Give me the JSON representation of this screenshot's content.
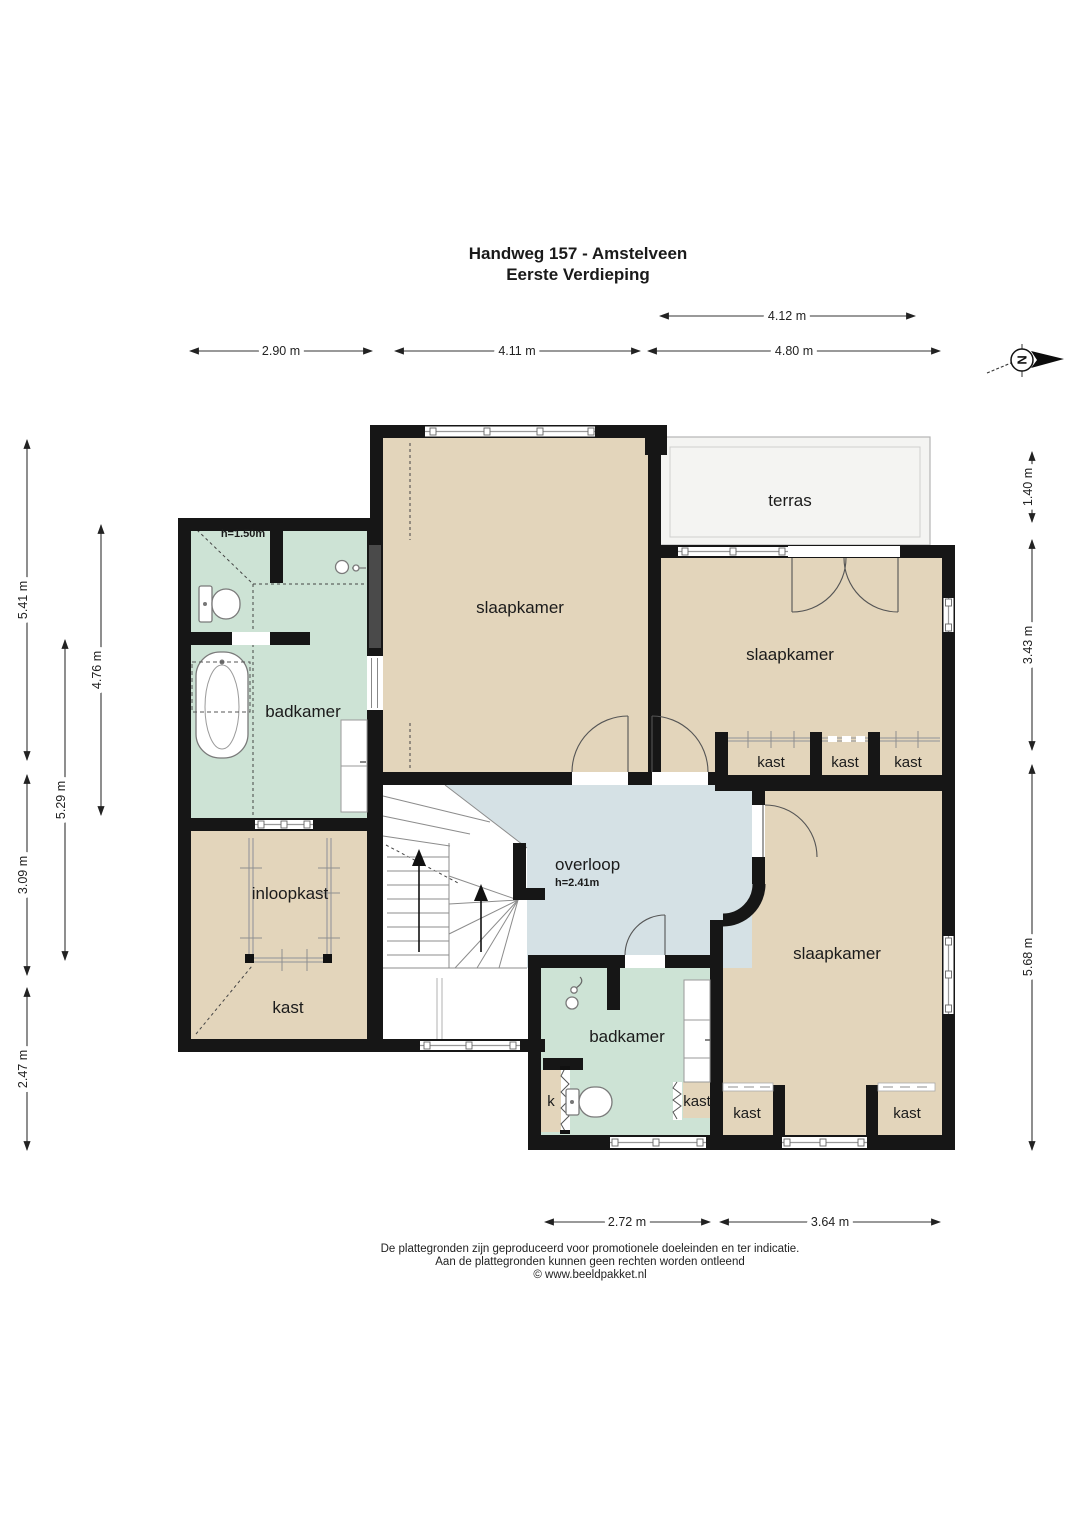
{
  "title": {
    "line1": "Handweg 157 - Amstelveen",
    "line2": "Eerste Verdieping"
  },
  "labels": {
    "bedroom": "slaapkamer",
    "bathroom": "badkamer",
    "terrace": "terras",
    "landing": "overloop",
    "landing_height": "h=2.41m",
    "bathroom_height": "h=1.50m",
    "walkin_closet": "inloopkast",
    "closet": "kast",
    "closet_small": "k"
  },
  "dimensions": {
    "top_terrace": "4.12 m",
    "top_left": "2.90 m",
    "top_middle": "4.11 m",
    "top_right": "4.80 m",
    "left_upper": "5.41 m",
    "left_mid": "3.09 m",
    "left_lower": "2.47 m",
    "left_col2": "5.29 m",
    "left_col3": "4.76 m",
    "right_top": "1.40 m",
    "right_mid": "3.43 m",
    "right_bottom": "5.68 m",
    "bottom_left": "2.72 m",
    "bottom_right": "3.64 m"
  },
  "compass": {
    "north_letter": "N"
  },
  "footer": {
    "line1": "De plattegronden zijn geproduceerd voor promotionele doeleinden en ter indicatie.",
    "line2": "Aan de plattegronden kunnen geen rechten worden ontleend",
    "line3": "© www.beeldpakket.nl"
  },
  "colors": {
    "wall": "#161616",
    "floor_tan": "#e3d5bb",
    "floor_mint": "#cde3d5",
    "floor_blue": "#d5e1e5",
    "terrace": "#f4f4f2"
  }
}
